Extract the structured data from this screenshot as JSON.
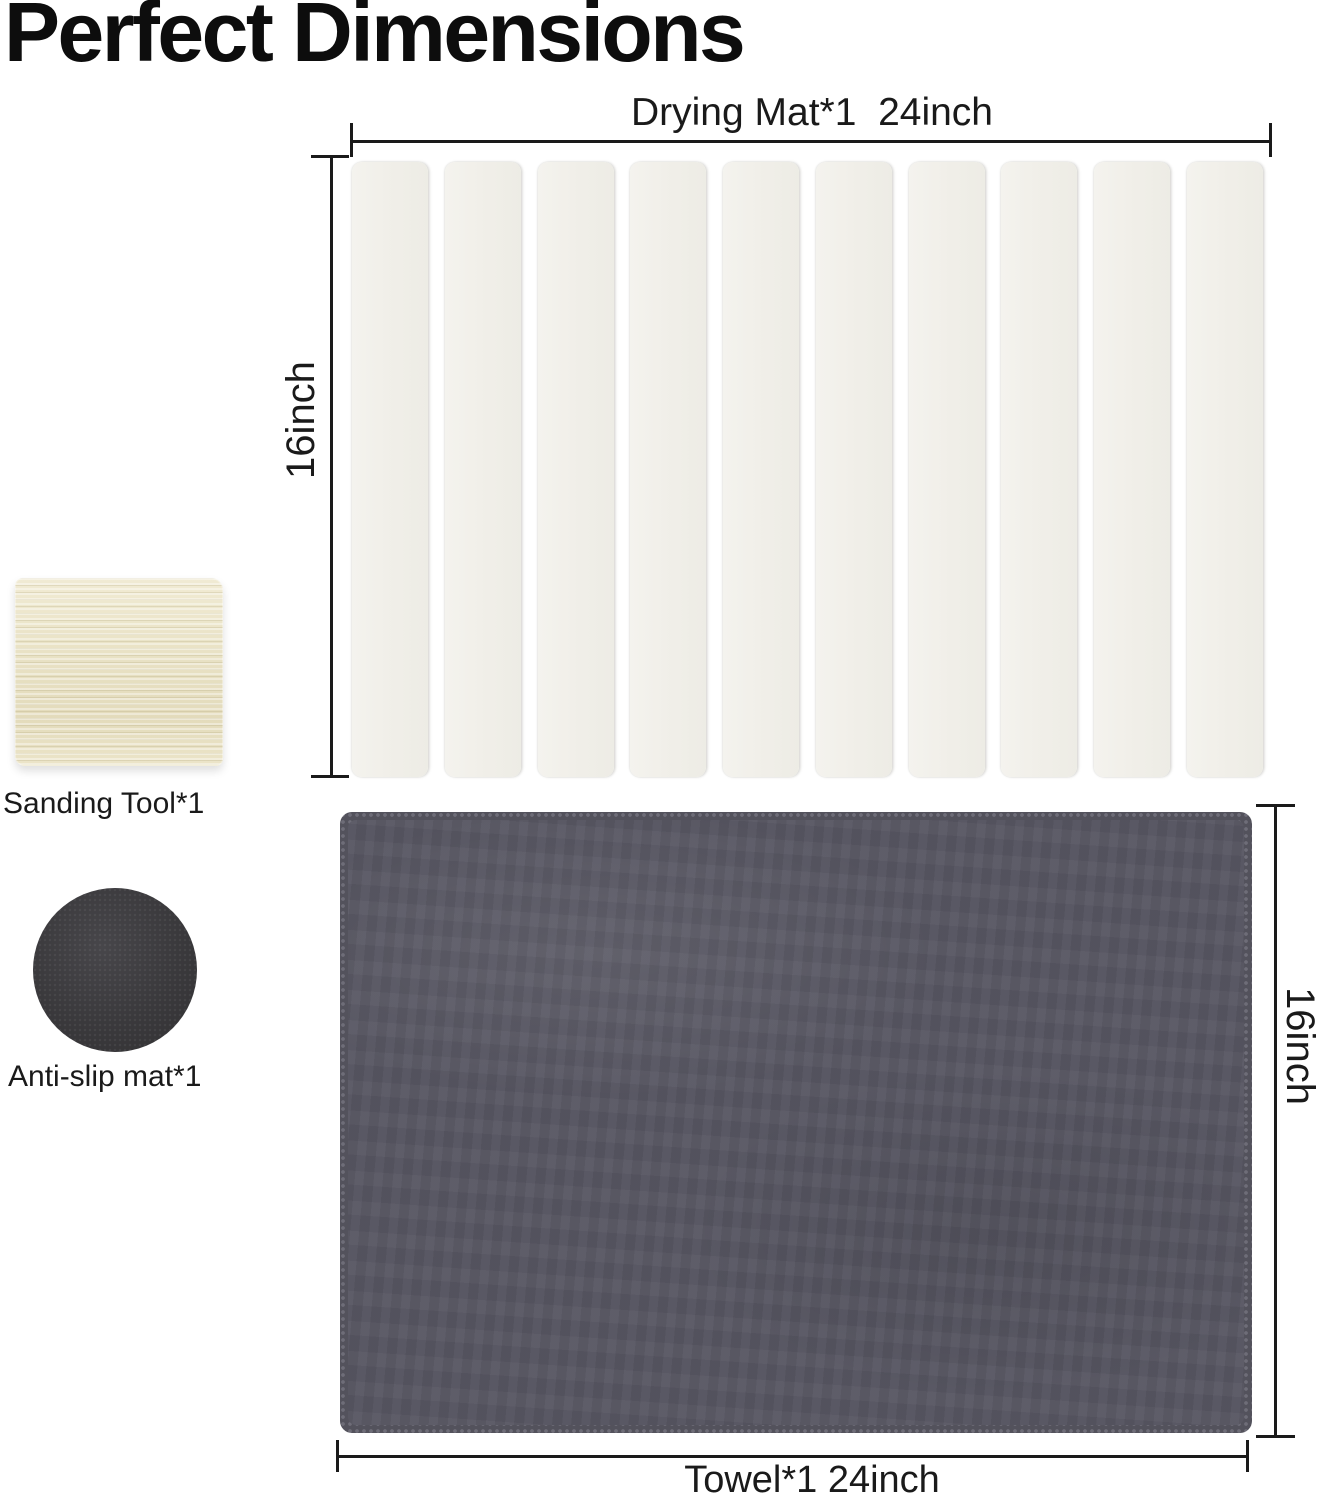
{
  "page": {
    "title": "Perfect Dimensions",
    "background_color": "#ffffff",
    "line_color": "#1a1a1a"
  },
  "drying_mat": {
    "label": "Drying Mat*1  24inch",
    "width_label": "24inch",
    "height_label": "16inch",
    "quantity_text": "*1",
    "slat_count": 10,
    "slat_color": "#f1efe9"
  },
  "sanding_tool": {
    "label": "Sanding Tool*1",
    "color": "#e9e2c5"
  },
  "anti_slip_mat": {
    "label": "Anti-slip mat*1",
    "color": "#3a393c"
  },
  "towel": {
    "label": "Towel*1 24inch",
    "width_label": "24inch",
    "height_label": "16inch",
    "color": "#575662"
  }
}
